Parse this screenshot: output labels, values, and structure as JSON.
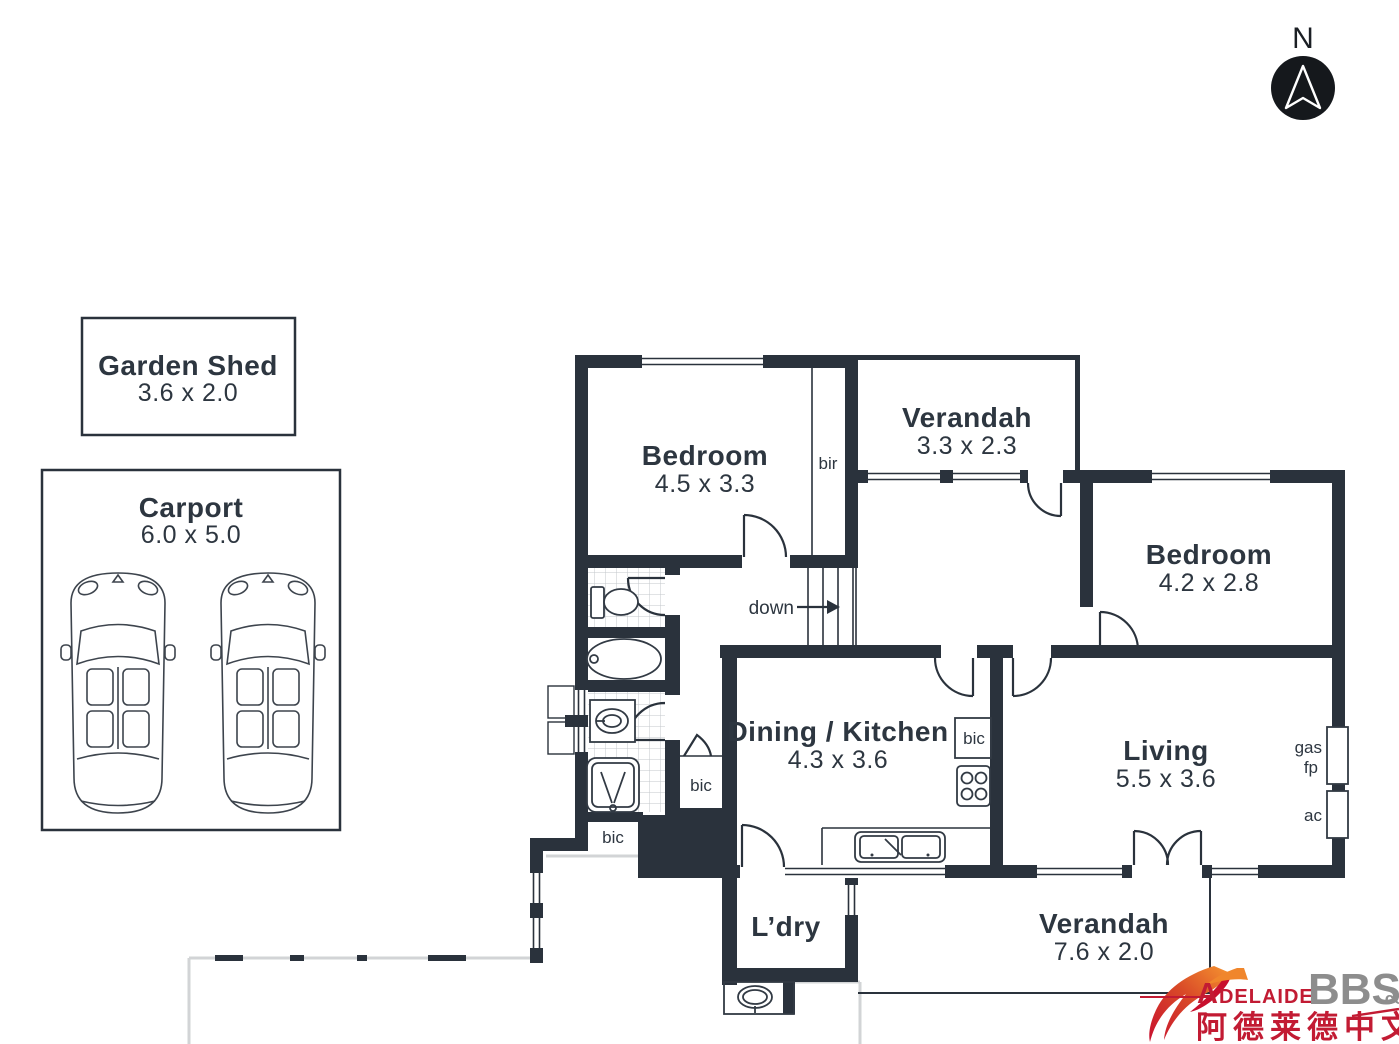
{
  "compass": {
    "label": "N"
  },
  "outbuildings": {
    "garden_shed": {
      "name": "Garden Shed",
      "dims": "3.6 x 2.0"
    },
    "carport": {
      "name": "Carport",
      "dims": "6.0 x 5.0"
    }
  },
  "rooms": {
    "bedroom1": {
      "name": "Bedroom",
      "dims": "4.5 x 3.3"
    },
    "verandah_top": {
      "name": "Verandah",
      "dims": "3.3 x 2.3"
    },
    "bedroom2": {
      "name": "Bedroom",
      "dims": "4.2 x 2.8"
    },
    "dining_kitchen": {
      "name": "Dining / Kitchen",
      "dims": "4.3 x 3.6"
    },
    "living": {
      "name": "Living",
      "dims": "5.5 x 3.6"
    },
    "laundry": {
      "name": "L’dry"
    },
    "verandah_bottom": {
      "name": "Verandah",
      "dims": "7.6 x 2.0"
    }
  },
  "annotations": {
    "bir": "bir",
    "bic_hall": "bic",
    "bic_bath": "bic",
    "bic_kitchen": "bic",
    "down": "down",
    "gas": "gas",
    "fp": "fp",
    "ac": "ac"
  },
  "watermark": {
    "brand_red": "Adelaide",
    "brand_gray": "BBS",
    "brand_suffix": ".com",
    "chinese": "阿德莱德中文网"
  },
  "colors": {
    "wall": "#2a323c",
    "accent_red": "#c21b33",
    "accent_gray": "#8d8d8d",
    "flame_orange": "#f0862c"
  }
}
